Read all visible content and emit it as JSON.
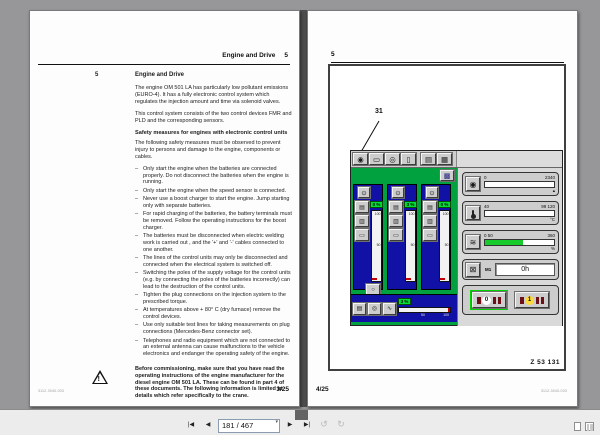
{
  "viewer": {
    "page_field": "181 / 467",
    "nav": {
      "first": "|◀",
      "prev": "◀",
      "next": "▶",
      "last": "▶|",
      "caret": "▾",
      "view_prev": "↺",
      "view_next": "↻"
    }
  },
  "left_page": {
    "header_title": "Engine and Drive",
    "header_number": "5",
    "section_number": "5",
    "section_title": "Engine and Drive",
    "para1": "The engine OM 501 LA has particularly low pollutant emissions (EURO-4). It has a fully electronic control system which regulates the injection amount and time via solenoid valves.",
    "para2": "This control system consists of the two control devices FMR and PLD and the corresponding sensors.",
    "safety_heading": "Safety measures for engines with electronic control units",
    "safety_intro": "The following safety measures must be observed to prevent injury to persons and damage to the engine, components or cables.",
    "bullet_marker": "–",
    "bullets": [
      "Only start the engine when the batteries are connected properly. Do not disconnect the batteries when the engine is running.",
      "Only start the engine when the speed sensor is connected.",
      "Never use a boost charger to start the engine. Jump starting only with separate batteries.",
      "For rapid charging of the batteries, the battery terminals must be removed. Follow the operating instructions for the boost charger.",
      "The batteries must be disconnected when electric welding work is carried out , and the '+' and '-' cables connected to one another.",
      "The lines of the control units may only be disconnected and connected when the electrical system is switched off.",
      "Switching the poles of the supply voltage for the control units (e.g. by connecting the poles of the batteries incorrectly) can lead to the destruction of the control units.",
      "Tighten the plug connections on the injection system to the prescribed torque.",
      "At temperatures above + 80° C (dry furnace) remove the control devices.",
      "Use only suitable test lines for taking measurements on plug connections (Mercedes-Benz connector set).",
      "Telephones and radio equipment which are not connected to an external antenna can cause malfunctions to the vehicle electronics and endanger the operating safety of the engine."
    ],
    "warning_text": "Before commissioning, make sure that you have read the operating instructions of the engine manufacturer for the diesel engine OM 501 LA. These can be found in part 4 of these documents. The following information is limited to details which refer specifically to the crane.",
    "footer_code": "3112-3040-003",
    "footer_page": "3/25"
  },
  "right_page": {
    "header_number": "5",
    "callout_label": "31",
    "figure_code": "Z 53 131",
    "footer_page": "4/25",
    "footer_code": "3112-3040-003",
    "panel": {
      "toolbar_icons": [
        {
          "name": "tachometer-icon",
          "glyph": "◉"
        },
        {
          "name": "carrier-icon",
          "glyph": "▭"
        },
        {
          "name": "hoist-icon",
          "glyph": "◎"
        },
        {
          "name": "cab-icon",
          "glyph": "▯"
        },
        {
          "name": "mast-icon",
          "glyph": "▤"
        },
        {
          "name": "winch-icon",
          "glyph": "▦"
        }
      ],
      "menu_icon_glyph": "▩",
      "col_icons": {
        "top": "⊙",
        "stack0": "▤",
        "stack1": "▥",
        "stack2": "▭",
        "extra": "○"
      },
      "columns": [
        {
          "value": "0 %",
          "scale_top": "100",
          "scale_mid": "50"
        },
        {
          "value": "3 %",
          "scale_top": "100",
          "scale_mid": "50"
        },
        {
          "value": "0 %",
          "scale_top": "100",
          "scale_mid": "50"
        }
      ],
      "bottom_icons": {
        "winch": "▤",
        "rotate": "◎",
        "lever": "∿"
      },
      "bottom_gauge": {
        "value": "3 %",
        "mark50": "50",
        "mark100": "100"
      },
      "gauges": [
        {
          "glyph": "◉",
          "left": "0",
          "right": "2340",
          "unit": "▴",
          "fill": "0%"
        },
        {
          "glyph": "",
          "left": "40",
          "right": "99  120",
          "unit": "°C",
          "fill": "0%"
        },
        {
          "glyph": "≋",
          "left": "0  50",
          "right": "360",
          "unit": "%",
          "fill": "55%"
        }
      ],
      "hours": {
        "icon_glyph": "⊠",
        "label": "M1",
        "value": "0h"
      },
      "indicators": [
        {
          "digit": "0"
        },
        {
          "digit": "1"
        }
      ]
    }
  }
}
